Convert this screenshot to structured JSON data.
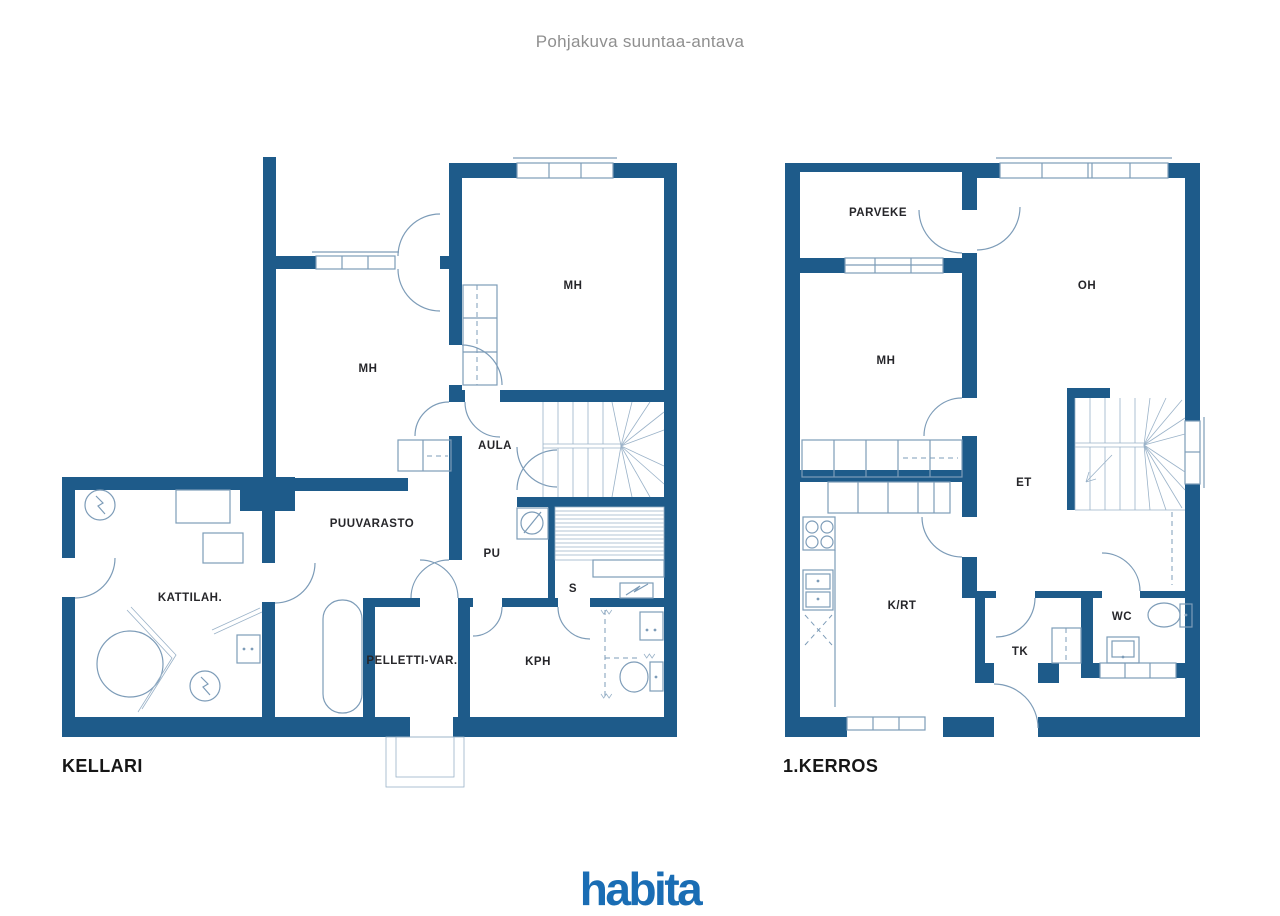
{
  "sheet": {
    "title": "Pohjakuva suuntaa-antava",
    "footer_logo": "habita"
  },
  "colors": {
    "wall": "#1e5b8a",
    "fixture_line": "#7d9cb8",
    "label_text": "#26262a",
    "title_text": "#8f8f8f",
    "logo_blue": "#1a6db4"
  },
  "floors": [
    {
      "caption": "KELLARI",
      "rooms": [
        {
          "label": "MH"
        },
        {
          "label": "MH"
        },
        {
          "label": "AULA"
        },
        {
          "label": "PUUVARASTO"
        },
        {
          "label": "PU"
        },
        {
          "label": "S"
        },
        {
          "label": "KATTILAH."
        },
        {
          "label": "PELLETTI-VAR."
        },
        {
          "label": "KPH"
        }
      ]
    },
    {
      "caption": "1.KERROS",
      "rooms": [
        {
          "label": "PARVEKE"
        },
        {
          "label": "MH"
        },
        {
          "label": "OH"
        },
        {
          "label": "ET"
        },
        {
          "label": "K/RT"
        },
        {
          "label": "TK"
        },
        {
          "label": "WC"
        }
      ]
    }
  ]
}
